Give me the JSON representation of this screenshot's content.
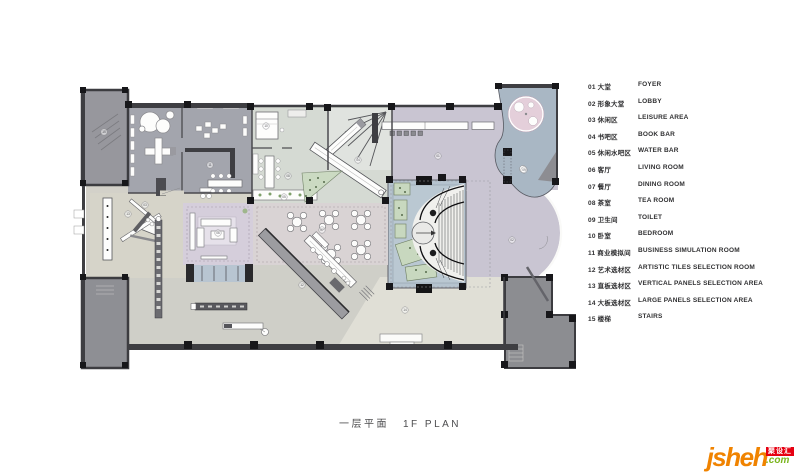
{
  "plan_title": {
    "zh": "一层平面",
    "en": "1F PLAN"
  },
  "legend": {
    "items": [
      {
        "num": "01",
        "zh": "大堂",
        "en": "FOYER"
      },
      {
        "num": "02",
        "zh": "形象大堂",
        "en": "LOBBY"
      },
      {
        "num": "03",
        "zh": "休闲区",
        "en": "LEISURE AREA"
      },
      {
        "num": "04",
        "zh": "书吧区",
        "en": "BOOK BAR"
      },
      {
        "num": "05",
        "zh": "休闲水吧区",
        "en": "WATER BAR"
      },
      {
        "num": "06",
        "zh": "客厅",
        "en": "LIVING ROOM"
      },
      {
        "num": "07",
        "zh": "餐厅",
        "en": "DINING ROOM"
      },
      {
        "num": "08",
        "zh": "茶室",
        "en": "TEA ROOM"
      },
      {
        "num": "09",
        "zh": "卫生间",
        "en": "TOILET"
      },
      {
        "num": "10",
        "zh": "卧室",
        "en": "BEDROOM"
      },
      {
        "num": "11",
        "zh": "商业模拟间",
        "en": "BUSINESS SIMULATION ROOM"
      },
      {
        "num": "12",
        "zh": "艺术选材区",
        "en": "ARTISTIC TILES SELECTION ROOM"
      },
      {
        "num": "13",
        "zh": "直板选材区",
        "en": "VERTICAL PANELS SELECTION AREA"
      },
      {
        "num": "14",
        "zh": "大板选材区",
        "en": "LARGE PANELS SELECTION AREA"
      },
      {
        "num": "15",
        "zh": "楼梯",
        "en": "STAIRS"
      }
    ]
  },
  "logo": {
    "main": "jsheh",
    "badge": "聚设汇",
    "tld": ".com"
  },
  "plan": {
    "markers": [
      {
        "n": "01",
        "x": 378,
        "y": 86
      },
      {
        "n": "02",
        "x": 452,
        "y": 170
      },
      {
        "n": "03",
        "x": 85,
        "y": 135
      },
      {
        "n": "04",
        "x": 298,
        "y": 90
      },
      {
        "n": "05",
        "x": 224,
        "y": 127
      },
      {
        "n": "06",
        "x": 158,
        "y": 163
      },
      {
        "n": "07",
        "x": 262,
        "y": 160
      },
      {
        "n": "08",
        "x": 228,
        "y": 106
      },
      {
        "n": "09",
        "x": 464,
        "y": 100
      },
      {
        "n": "10",
        "x": 206,
        "y": 56
      },
      {
        "n": "11",
        "x": 150,
        "y": 95
      },
      {
        "n": "12",
        "x": 242,
        "y": 215
      },
      {
        "n": "13",
        "x": 68,
        "y": 144
      },
      {
        "n": "14",
        "x": 345,
        "y": 240
      },
      {
        "n": "15",
        "x": 44,
        "y": 62
      }
    ]
  },
  "palette": {
    "wall": "#3e3e42",
    "column": "#17171a",
    "gray_room": "#a3a5ad",
    "dark_room": "#8e8f94",
    "green_room": "#d5dad3",
    "lavender": "#c9c5d2",
    "blue_zone": "#a9b7c4",
    "pink_table": "#e4cfda",
    "stair_hall": "#b5c3ce",
    "plant": "#c8d8bf",
    "dining": "#d9d3d4",
    "living": "#d5cedb",
    "leisure": "#d6d4c9",
    "floor": "#cfcfc8",
    "floor_light": "#e0dfd6",
    "logo_orange": "#f08300",
    "logo_red": "#e60012",
    "logo_green": "#7ab51d"
  }
}
